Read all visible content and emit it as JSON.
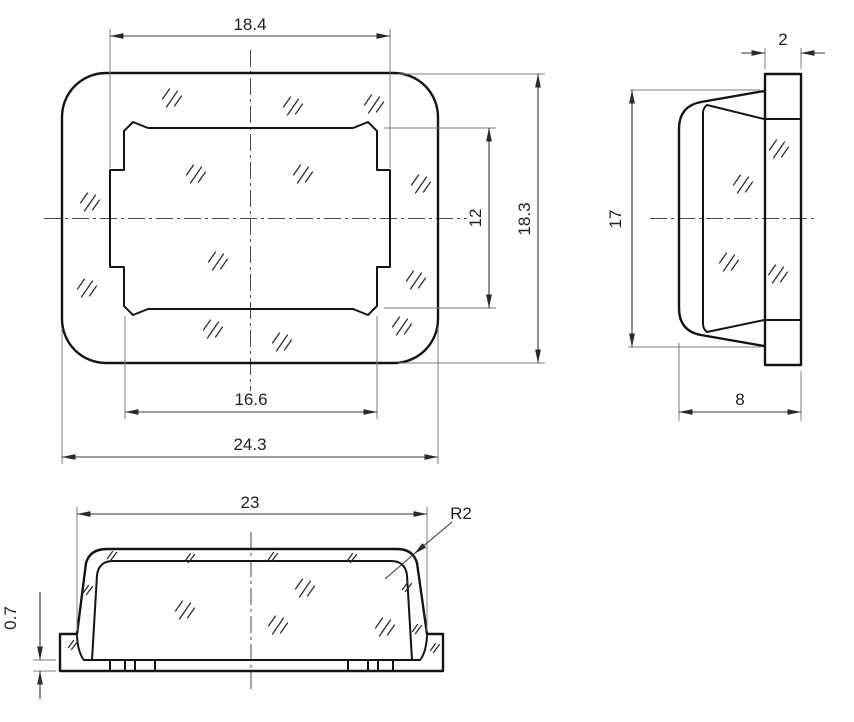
{
  "drawing": {
    "title": "cap three-view technical drawing",
    "front": {
      "top_width": "18.4",
      "inner_height": "12",
      "outer_height": "18.3",
      "inner_width": "16.6",
      "outer_width": "24.3"
    },
    "side": {
      "rim_thickness": "2",
      "height": "17",
      "depth": "8"
    },
    "bottom": {
      "width": "23",
      "corner_radius": "R2",
      "base_thickness": "0.7"
    },
    "colors": {
      "line": "#141414",
      "dim": "#3a3a3a",
      "background": "#ffffff"
    }
  }
}
